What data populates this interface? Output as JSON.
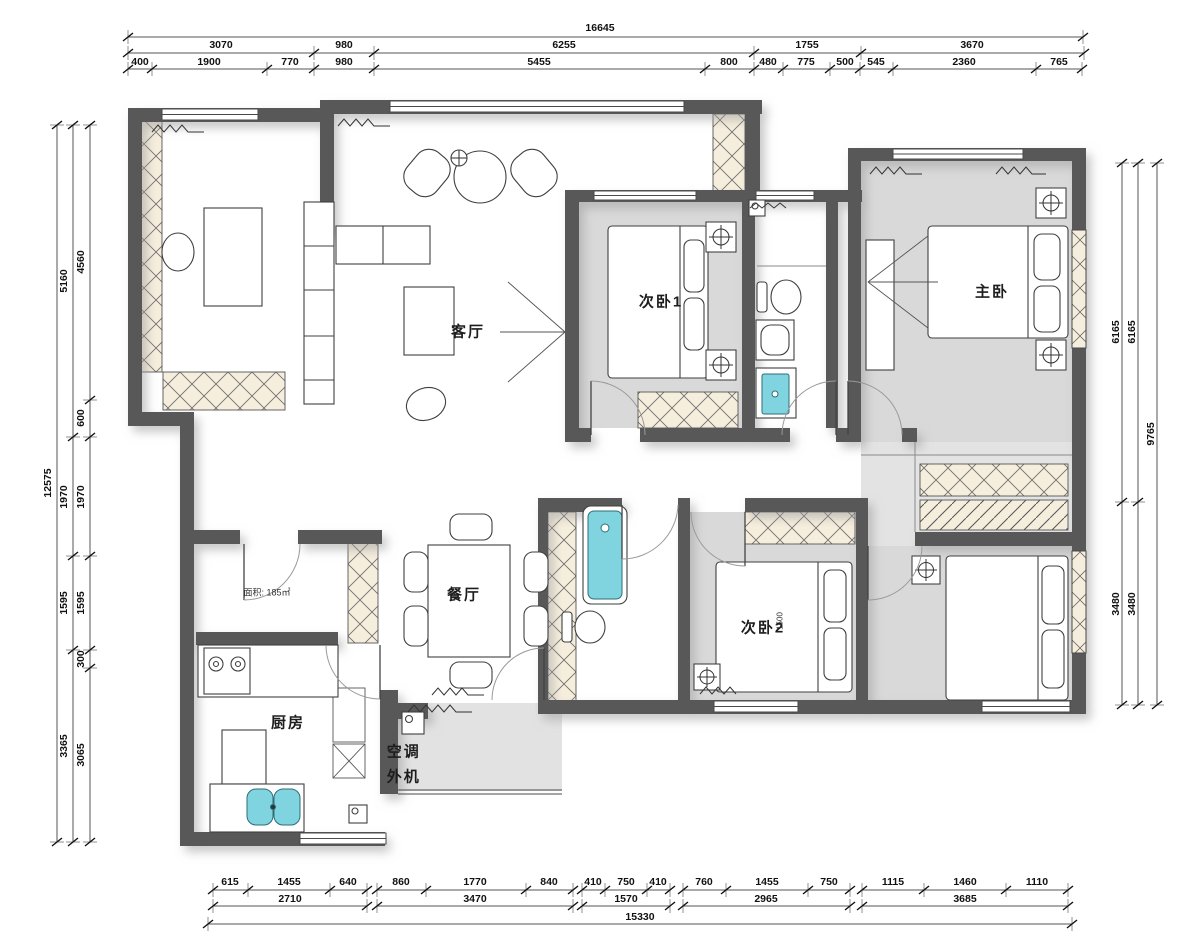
{
  "plan_title": "residential floor plan",
  "rooms": {
    "living": "客厅",
    "dining": "餐厅",
    "kitchen": "厨房",
    "ac_unit": "空调外机",
    "bedroom1": "次卧1",
    "bedroom2": "次卧2",
    "master": "主卧"
  },
  "notes": {
    "area": "面积: 185㎡",
    "bed2_dim": "1500"
  },
  "dims": {
    "top": {
      "total": "16645",
      "row2": [
        "3070",
        "980",
        "6255",
        "1755",
        "3670"
      ],
      "row3": [
        "400",
        "1900",
        "770",
        "980",
        "5455",
        "800",
        "480",
        "775",
        "500",
        "545",
        "2360",
        "765"
      ]
    },
    "bottom": {
      "row1": [
        "615",
        "1455",
        "640",
        "860",
        "1770",
        "840",
        "410",
        "750",
        "410",
        "760",
        "1455",
        "750",
        "1115",
        "1460",
        "1110"
      ],
      "row2": [
        "2710",
        "3470",
        "1570",
        "2965",
        "3685"
      ],
      "total": "15330"
    },
    "left": {
      "total": "12575",
      "mid": [
        "5160",
        "1970",
        "1595",
        "3365"
      ],
      "inner": [
        "4560",
        "600",
        "1970",
        "1595",
        "300",
        "3065"
      ]
    },
    "right": {
      "inner": [
        "6165",
        "3480"
      ],
      "mid": [
        "6165",
        "3480"
      ],
      "total": "9765"
    }
  },
  "colors": {
    "wall": "#595959",
    "floor": "#d9d9d9",
    "cabinet": "#f6eedd",
    "fixture": "#7fd4e0"
  }
}
